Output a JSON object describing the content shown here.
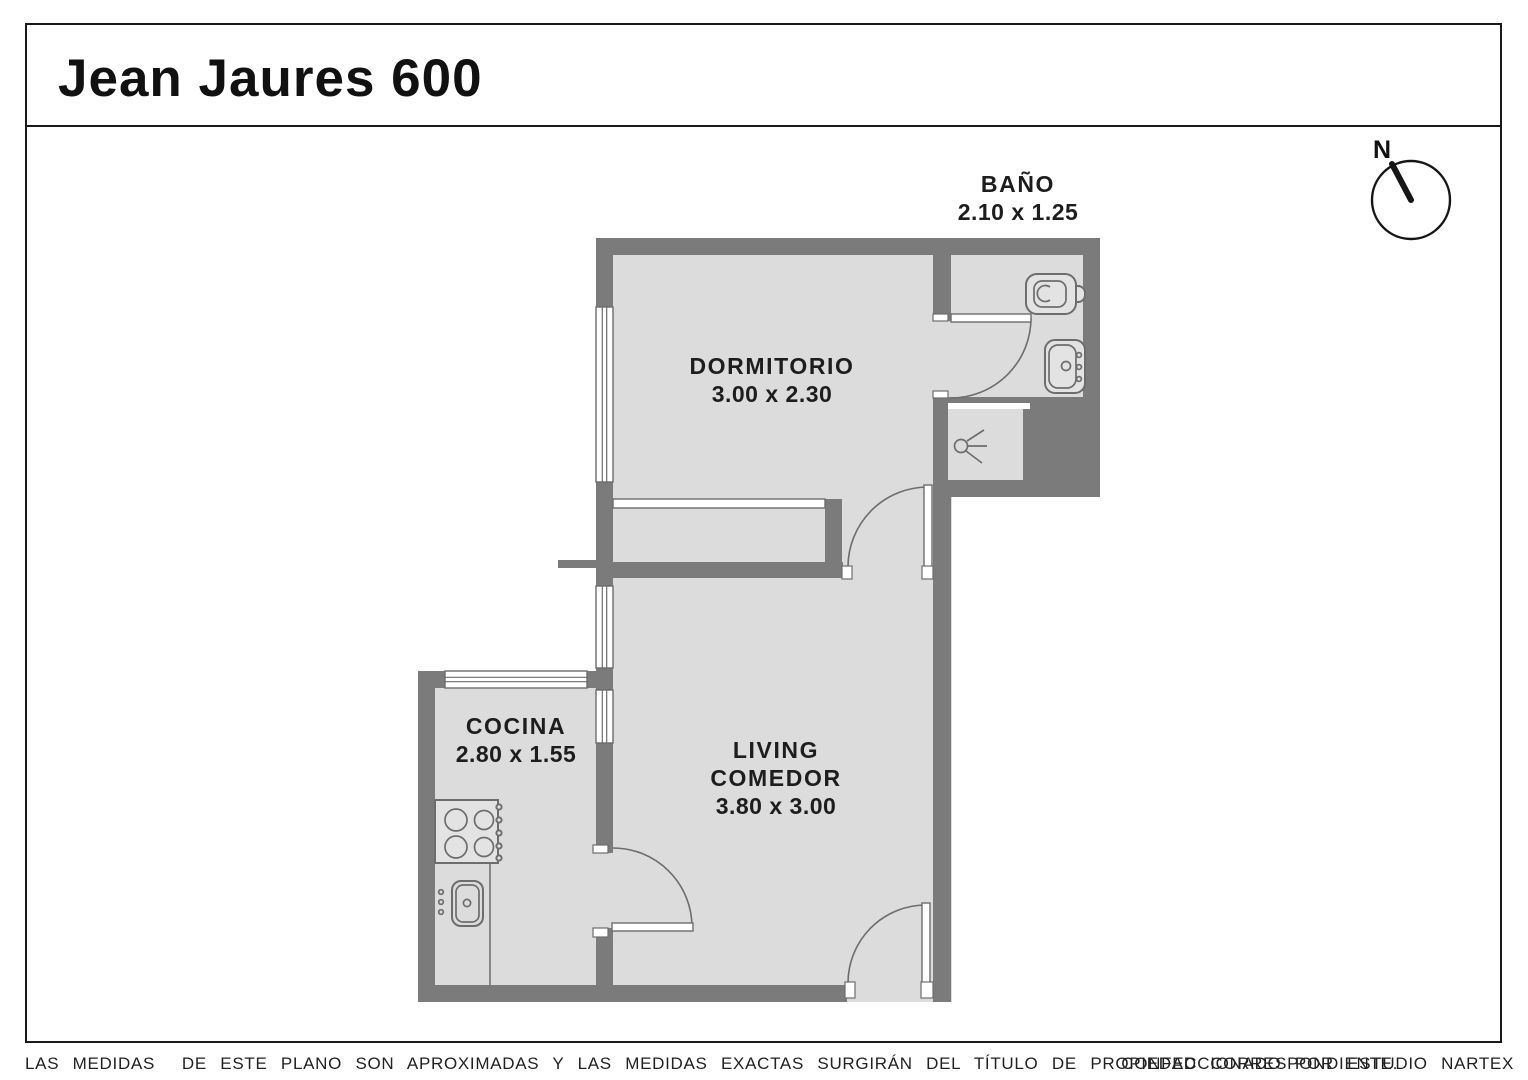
{
  "title": "Jean Jaures 600",
  "compass": {
    "north_label": "N"
  },
  "rooms": {
    "bano": {
      "name": "BAÑO",
      "dims": "2.10 x 1.25"
    },
    "dormitorio": {
      "name": "DORMITORIO",
      "dims": "3.00 x 2.30"
    },
    "cocina": {
      "name": "COCINA",
      "dims": "2.80 x 1.55"
    },
    "living": {
      "line1": "LIVING",
      "line2": "COMEDOR",
      "dims": "3.80 x 3.00"
    }
  },
  "footer": {
    "disclaimer": "LAS MEDIDAS  DE ESTE PLANO SON APROXIMADAS Y LAS MEDIDAS EXACTAS SURGIRÁN DEL TÍTULO DE PROPIEDAD CORRESPONDIENTE.",
    "credit": "CONFECCIONADO POR ESTUDIO NARTEX"
  },
  "colors": {
    "wall": "#7b7b7b",
    "floor": "#dcdcdc",
    "line": "#6d6d6d",
    "outline": "#1a1a1a",
    "text": "#1d1d1d"
  }
}
